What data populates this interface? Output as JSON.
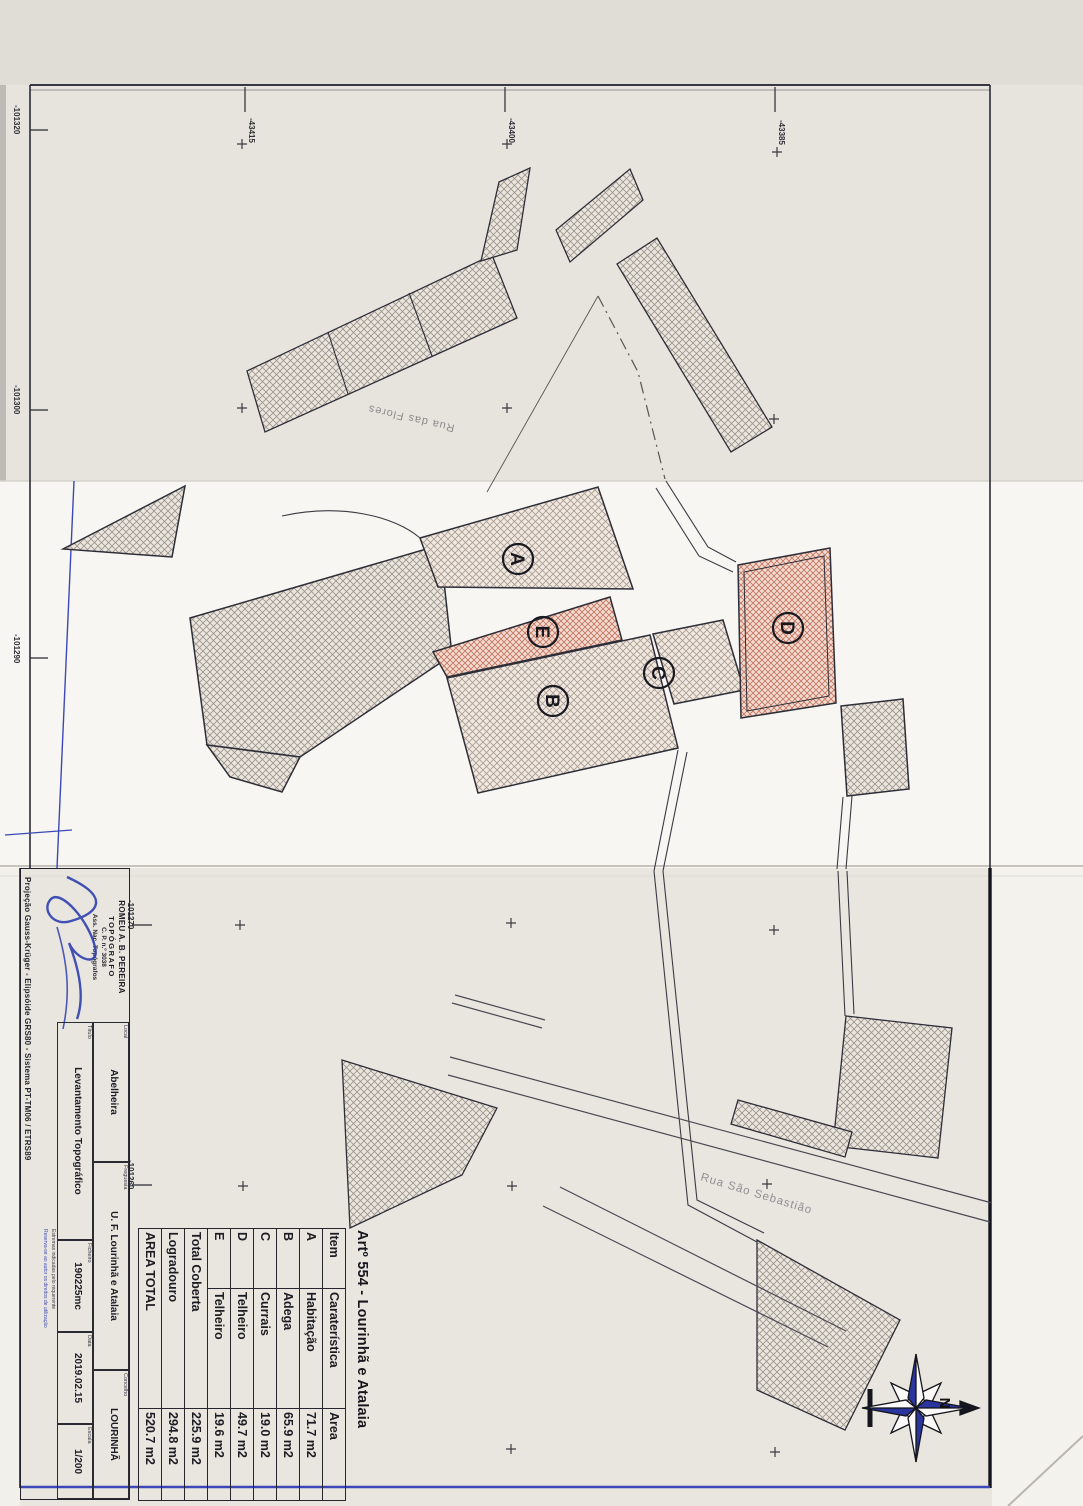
{
  "table": {
    "title": "Artº 554 - Lourinhã e Atalaia",
    "headers": [
      "Item",
      "Caraterística",
      "Area"
    ],
    "rows": [
      {
        "item": "A",
        "carateristica": "Habitação",
        "area": "71.7 m2"
      },
      {
        "item": "B",
        "carateristica": "Adega",
        "area": "65.9 m2"
      },
      {
        "item": "C",
        "carateristica": "Currais",
        "area": "19.0 m2"
      },
      {
        "item": "D",
        "carateristica": "Telheiro",
        "area": "49.7 m2"
      },
      {
        "item": "E",
        "carateristica": "Telheiro",
        "area": "19.6 m2"
      }
    ],
    "totals": [
      {
        "label": "Total Coberta",
        "area": "225.9 m2"
      },
      {
        "label": "Logradouro",
        "area": "294.8 m2"
      },
      {
        "label": "AREA TOTAL",
        "area": "520.7 m2"
      }
    ]
  },
  "title_block": {
    "stamp": {
      "name": "ROMEU A. B. PEREIRA",
      "role": "TOPÓGRAFO",
      "license": "C. P. n.º 3038",
      "assoc": "Ass. Nac. Topógrafos"
    },
    "fields": {
      "local": {
        "label": "Local",
        "value": "Abelheira"
      },
      "freguesia": {
        "label": "Freguesia",
        "value": "U. F. Lourinhã e Atalaia"
      },
      "concelho": {
        "label": "Concelho",
        "value": "LOURINHÃ"
      },
      "titulo": {
        "label": "Título",
        "value": "Levantamento Topográfico"
      },
      "ficheiro": {
        "label": "Ficheiro",
        "value": "190225mc"
      },
      "data": {
        "label": "Data",
        "value": "2019.02.15"
      },
      "escala": {
        "label": "Escala",
        "value": "1/200"
      }
    },
    "projection": "Projeção Gauss-Krüger - Elipsóide GRS80 - Sistema PT-TM06 / ETRS89",
    "fine_print_1": "Estremas indicadas pelo requerente",
    "fine_print_2": "Reserva-se ao autor os direitos de utilização"
  },
  "map": {
    "streets": [
      "Rua das Flores",
      "Rua São Sebastião"
    ],
    "building_labels": [
      "A",
      "B",
      "C",
      "D",
      "E"
    ],
    "coords_top": [
      "-43415",
      "-43400",
      "-43385"
    ],
    "coords_left": [
      "-101320",
      "-101300",
      "-101290"
    ],
    "coords_inner": [
      "-101270",
      "-101260"
    ],
    "north_label": "N"
  },
  "colors": {
    "ink_blue": "#3b49b8",
    "hatch_pink": "#c3735c",
    "paper": "#e9e6e0"
  }
}
